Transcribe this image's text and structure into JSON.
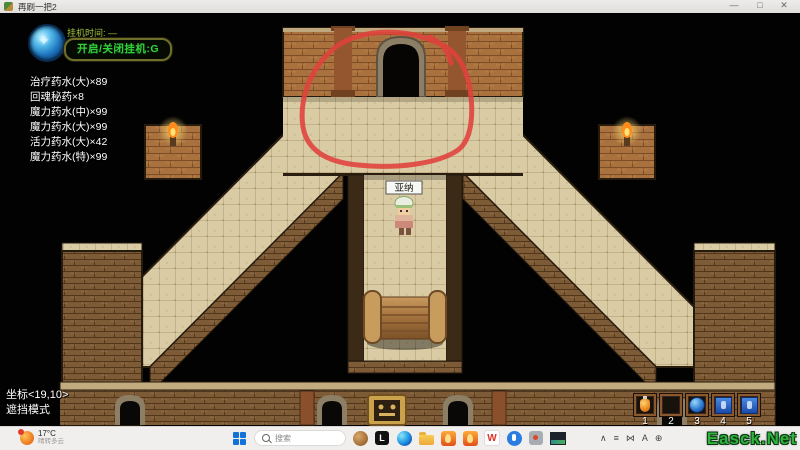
{
  "window": {
    "title": "再刷一把2",
    "controls": {
      "minimize": "—",
      "maximize": "□",
      "close": "✕"
    }
  },
  "hud": {
    "idle_timer_label": "挂机时间: —",
    "idle_toggle_button": "开启/关闭挂机:G",
    "inventory_items": [
      "治疗药水(大)×89",
      "回魂秘药×8",
      "魔力药水(中)×99",
      "魔力药水(大)×99",
      "活力药水(大)×42",
      "魔力药水(特)×99"
    ],
    "coordinates": "坐标<19,10>",
    "mode_label": "遮挡模式"
  },
  "player": {
    "name": "亚纳"
  },
  "map": {
    "annotation": {
      "shape": "hand-drawn-circle",
      "color": "#e0413c",
      "target": "top-center-door"
    },
    "features": [
      "arched-door",
      "tiled-floor",
      "brick-walls",
      "torches",
      "wooden-roller",
      "bottom-gate-wall"
    ]
  },
  "hotbar": {
    "slots": [
      {
        "num": "1",
        "item": "orange-potion"
      },
      {
        "num": "2",
        "item": "empty"
      },
      {
        "num": "3",
        "item": "blue-orb-potion"
      },
      {
        "num": "4",
        "item": "blue-scroll"
      },
      {
        "num": "5",
        "item": "blue-scroll"
      }
    ]
  },
  "taskbar": {
    "weather": {
      "temp": "17°C",
      "desc": "晴转多云"
    },
    "search_placeholder": "搜索",
    "app_glyphs": {
      "l_app": "L",
      "wps": "W"
    },
    "tray": [
      {
        "name": "chevron-up",
        "glyph": "∧"
      },
      {
        "name": "lines-indicator",
        "glyph": "≡"
      },
      {
        "name": "bowtie-indicator",
        "glyph": "⋈"
      },
      {
        "name": "ime-a",
        "glyph": "A"
      },
      {
        "name": "globe",
        "glyph": "⊕"
      }
    ]
  },
  "watermark": "Easck.Net",
  "colors": {
    "annotation_red": "#e0413c",
    "hud_green": "#34d13a",
    "floor_tan": "#d9cba3",
    "wall_brick": "#a8713e",
    "watermark_green": "#2fb33c"
  }
}
